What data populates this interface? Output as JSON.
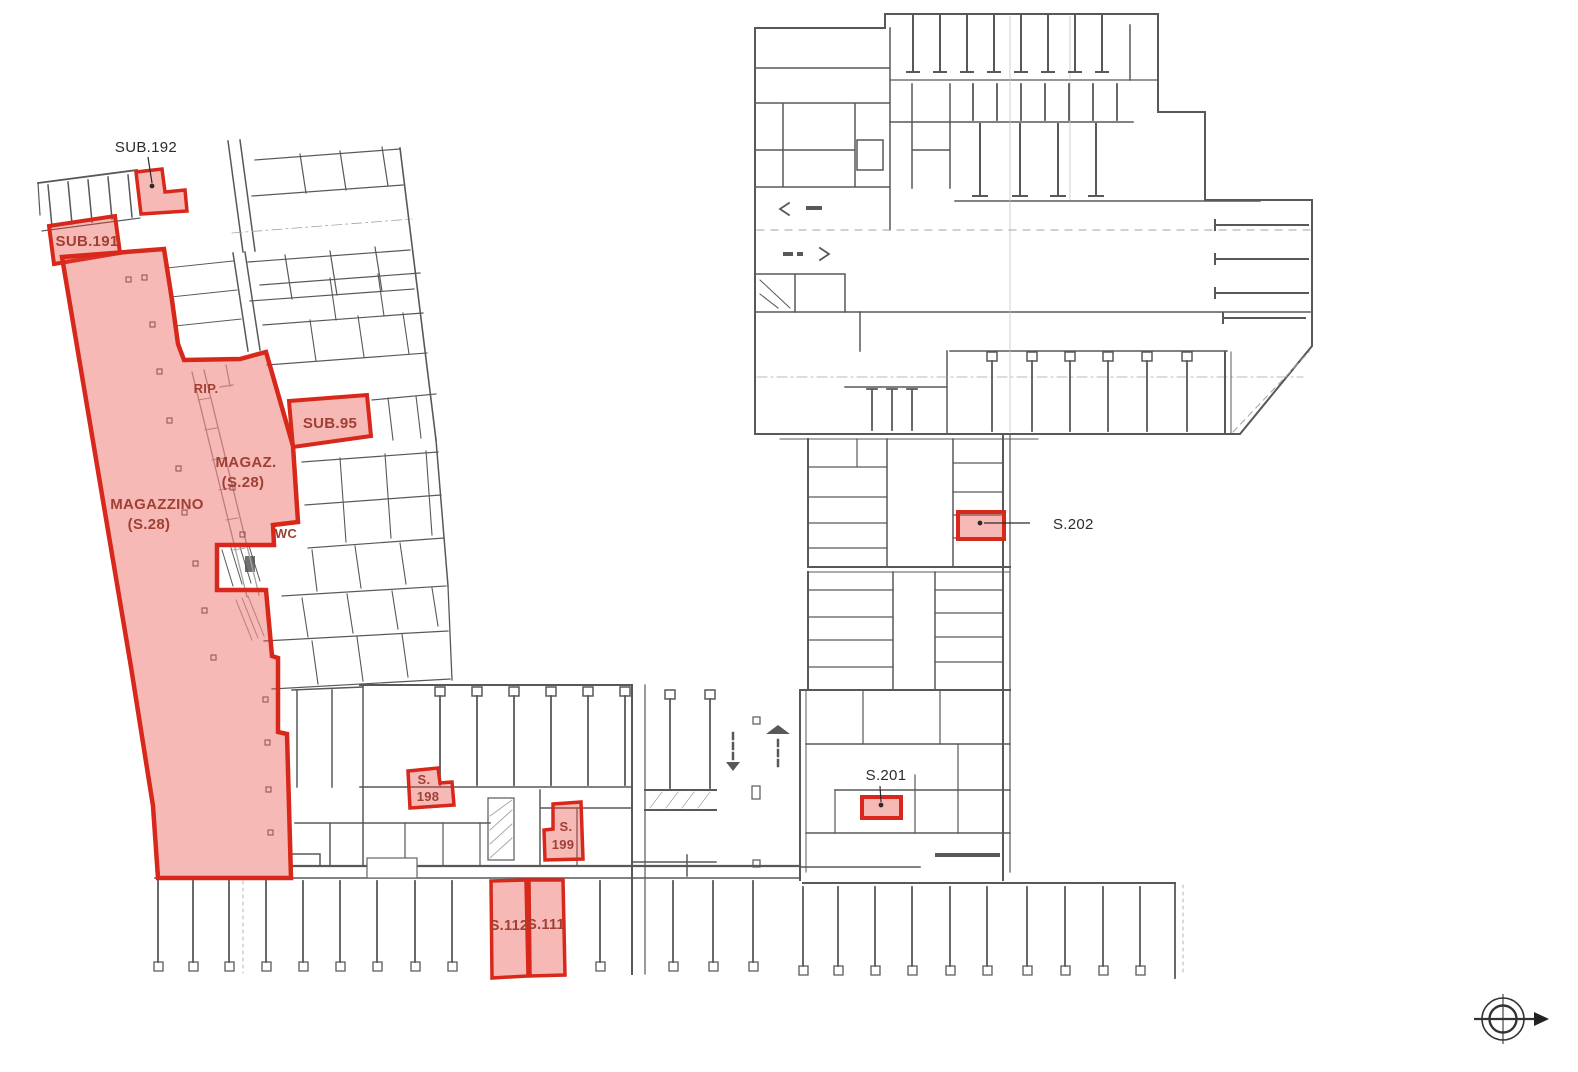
{
  "palette": {
    "background": "#ffffff",
    "linework_color": "#474747",
    "highlight_stroke": "#d7281b",
    "highlight_fill": "rgba(234,62,50,0.36)",
    "unit_label_color": "#a04035",
    "annotation_color": "#2b2b2b"
  },
  "units": {
    "sub192": {
      "label": "SUB.192"
    },
    "sub191": {
      "label": "SUB.191"
    },
    "magazzino": {
      "line1": "MAGAZZINO",
      "line2": "(S.28)"
    },
    "magaz": {
      "line1": "MAGAZ.",
      "line2": "(S.28)"
    },
    "rip": {
      "label": "RIP."
    },
    "sub95": {
      "label": "SUB.95"
    },
    "wc": {
      "label": "WC"
    },
    "s198": {
      "line1": "S.",
      "line2": "198"
    },
    "s199": {
      "line1": "S.",
      "line2": "199"
    },
    "s112": {
      "label": "S.112"
    },
    "s111": {
      "label": "S.111"
    },
    "s201": {
      "label": "S.201"
    },
    "s202": {
      "label": "S.202"
    }
  },
  "compass": {
    "icon": "north-compass"
  }
}
